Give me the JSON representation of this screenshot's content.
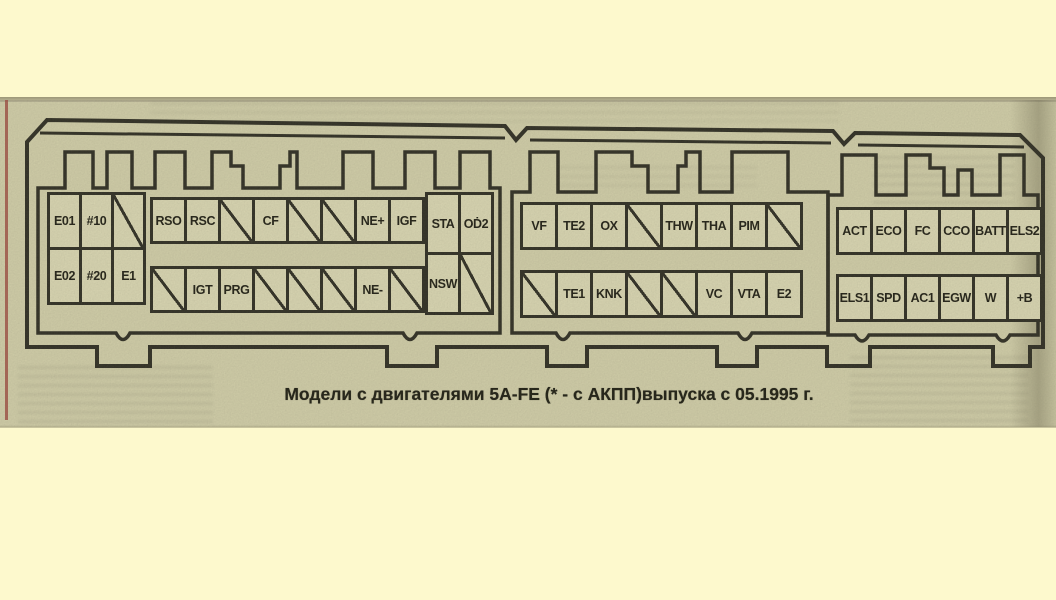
{
  "caption": "Модели с двигателями 5A-FE (* - с АКПП)выпуска с 05.1995 г.",
  "colors": {
    "paper": "#fdf9cd",
    "scan": "#d5d2ac",
    "cellbg": "#dedbb6",
    "line": "#2c2b21",
    "ink": "#1d1c12",
    "rededge": "#a0493e"
  },
  "connectors": [
    {
      "id": "connector-1",
      "groups": {
        "left": {
          "top": [
            "E01",
            "#10",
            ""
          ],
          "bottom": [
            "E02",
            "#20",
            "E1"
          ]
        },
        "middle": {
          "top": [
            "RSO",
            "RSC",
            "",
            "CF",
            "",
            "",
            "NE+",
            "IGF"
          ],
          "bottom": [
            "",
            "IGT",
            "PRG",
            "",
            "",
            "",
            "NE-",
            ""
          ]
        },
        "right": {
          "top": [
            "STA",
            "OḊ2"
          ],
          "bottom": [
            "NSW",
            ""
          ]
        }
      }
    },
    {
      "id": "connector-2",
      "groups": {
        "main": {
          "top": [
            "VF",
            "TE2",
            "OX",
            "",
            "THW",
            "THA",
            "PIM",
            ""
          ],
          "bottom": [
            "",
            "TE1",
            "KNK",
            "",
            "",
            "VC",
            "VTA",
            "E2"
          ]
        }
      }
    },
    {
      "id": "connector-3",
      "groups": {
        "main": {
          "top": [
            "ACT",
            "ECO",
            "FC",
            "CCO",
            "BATT",
            "ELS2"
          ],
          "bottom": [
            "ELS1",
            "SPD",
            "AC1",
            "EGW",
            "W",
            "+B"
          ]
        }
      }
    }
  ]
}
